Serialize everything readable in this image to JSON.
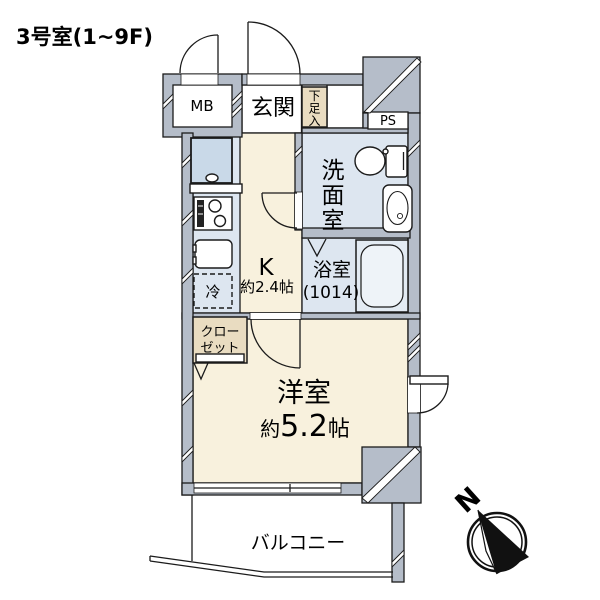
{
  "title": "3号室(1~9F)",
  "colors": {
    "wall": "#b5bdc9",
    "floor_cream": "#f8f1dd",
    "floor_wet_blue": "#dde6f0",
    "floor_tan": "#e9dcc1",
    "outline": "#1b1b1b",
    "background": "#ffffff"
  },
  "labels": {
    "mb": "MB",
    "entrance": "玄関",
    "shoe_storage": {
      "c1": "下",
      "c2": "足",
      "c3": "入"
    },
    "ps": "PS",
    "washroom": {
      "c1": "洗",
      "c2": "面",
      "c3": "室"
    },
    "bathroom": {
      "name": "浴室",
      "size": "(1014)"
    },
    "kitchen": {
      "name": "K",
      "size": "約2.4帖"
    },
    "refrigerator": "冷",
    "closet": {
      "line1": "クロー",
      "line2": "ゼット"
    },
    "western_room": {
      "name": "洋室",
      "size_about": "約",
      "size_value": "5.2",
      "size_unit": "帖"
    },
    "balcony": "バルコニー",
    "compass_north": "N"
  }
}
